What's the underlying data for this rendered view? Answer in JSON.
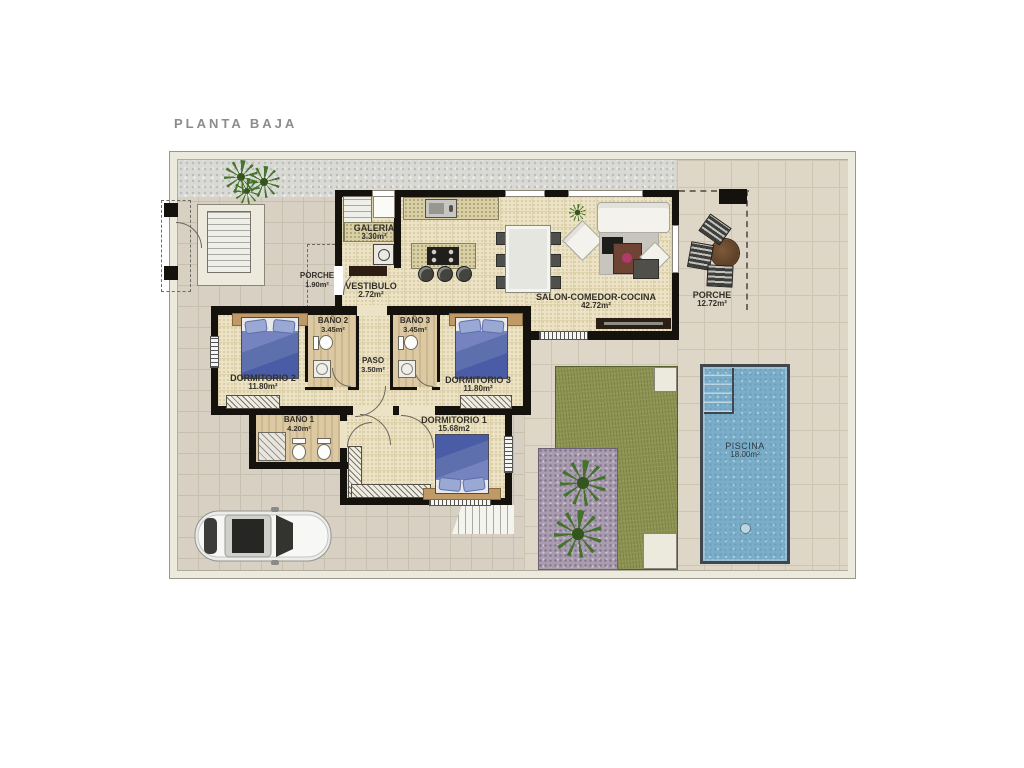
{
  "title": "PLANTA BAJA",
  "rooms": {
    "galeria": {
      "name": "GALERIA",
      "area": "3.30m²"
    },
    "vestibulo": {
      "name": "VESTIBULO",
      "area": "2.72m²"
    },
    "porche_entrada": {
      "name": "PORCHE",
      "area": "1.90m²"
    },
    "salon": {
      "name": "SALON-COMEDOR-COCINA",
      "area": "42.72m²"
    },
    "porche_lateral": {
      "name": "PORCHE",
      "area": "12.72m²"
    },
    "bano2": {
      "name": "BAÑO 2",
      "area": "3.45m²"
    },
    "bano3": {
      "name": "BAÑO 3",
      "area": "3.45m²"
    },
    "paso": {
      "name": "PASO",
      "area": "3.50m²"
    },
    "dormitorio2": {
      "name": "DORMITORIO 2",
      "area": "11.80m²"
    },
    "dormitorio3": {
      "name": "DORMITORIO 3",
      "area": "11.80m²"
    },
    "bano1": {
      "name": "BAÑO 1",
      "area": "4.20m²"
    },
    "dormitorio1": {
      "name": "DORMITORIO 1",
      "area": "15.68m2"
    },
    "piscina": {
      "name": "PISCINA",
      "area": "18.00m²"
    }
  },
  "colors": {
    "wall": "#15120d",
    "floor": "#ece3c6",
    "floor-grid": "#ddd2ab",
    "tile": "#d8d1c3",
    "tile-grid": "#c8c0ae",
    "terrace": "#ded7c8",
    "terrace-grid": "#cdc5b2",
    "band": "#eceadc",
    "gravel": "#d9d9d5",
    "lawn": "#8d9353",
    "gravelp": "#a89cae",
    "pool": "#7cadc8",
    "pool-border": "#3f464e",
    "wood": "#c09a66",
    "bed": "#5d6fad",
    "pillow": "#9aa8d4",
    "counter": "#d9cfa6",
    "darkwood": "#2e1d12",
    "label": "#33302a",
    "title": "#8c8c8c"
  }
}
